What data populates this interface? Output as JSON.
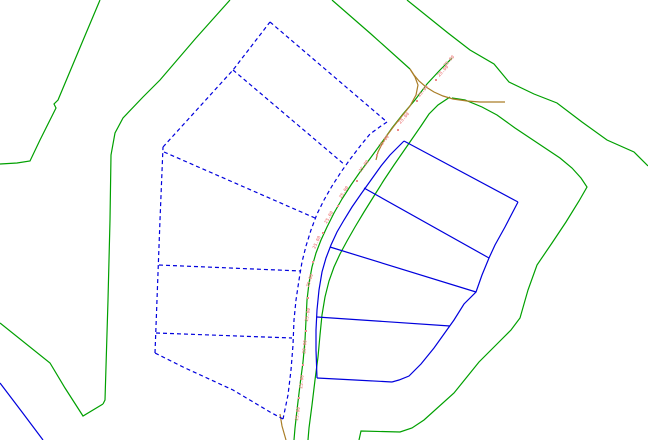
{
  "canvas": {
    "width": 648,
    "height": 440,
    "background": "#ffffff"
  },
  "palette": {
    "boundary_green": "#00a000",
    "parcel_blue": "#0000dd",
    "old_road_brown": "#aa7e28",
    "dimension_red": "#ef8a8a"
  },
  "layers": [
    {
      "name": "site-boundary-green",
      "color_key": "boundary_green",
      "dashed": false,
      "paths": [
        [
          [
            100,
            0
          ],
          [
            84,
            38
          ],
          [
            58,
            100
          ],
          [
            54,
            104
          ],
          [
            56,
            108
          ],
          [
            40,
            140
          ],
          [
            30,
            161
          ],
          [
            17,
            163
          ],
          [
            0,
            164
          ]
        ],
        [
          [
            0,
            323
          ],
          [
            50,
            363
          ],
          [
            65,
            388
          ],
          [
            83,
            416
          ],
          [
            103,
            404
          ]
        ],
        [
          [
            230,
            0
          ],
          [
            196,
            38
          ],
          [
            160,
            80
          ],
          [
            143,
            97
          ],
          [
            123,
            118
          ],
          [
            115,
            133
          ],
          [
            111,
            155
          ],
          [
            110,
            220
          ],
          [
            108,
            300
          ],
          [
            105,
            400
          ],
          [
            103,
            404
          ]
        ],
        [
          [
            332,
            0
          ],
          [
            371,
            34
          ],
          [
            410,
            69
          ]
        ],
        [
          [
            452,
            58
          ],
          [
            440,
            70
          ],
          [
            427,
            84
          ],
          [
            415,
            100
          ],
          [
            403,
            114
          ],
          [
            392,
            128
          ],
          [
            385,
            138
          ],
          [
            377,
            149
          ],
          [
            369,
            160
          ],
          [
            360,
            172
          ],
          [
            351,
            185
          ],
          [
            342,
            199
          ],
          [
            334,
            213
          ],
          [
            327,
            227
          ],
          [
            321,
            240
          ],
          [
            316,
            253
          ],
          [
            312,
            267
          ],
          [
            309,
            283
          ],
          [
            307,
            300
          ],
          [
            306,
            320
          ],
          [
            305,
            340
          ],
          [
            303,
            362
          ],
          [
            300,
            385
          ],
          [
            297,
            410
          ],
          [
            295,
            428
          ],
          [
            294,
            440
          ]
        ],
        [
          [
            450,
            97
          ],
          [
            438,
            105
          ],
          [
            429,
            114
          ],
          [
            421,
            126
          ],
          [
            412,
            139
          ],
          [
            403,
            152
          ],
          [
            394,
            165
          ],
          [
            384,
            180
          ],
          [
            374,
            196
          ],
          [
            364,
            212
          ],
          [
            355,
            227
          ],
          [
            347,
            241
          ],
          [
            340,
            254
          ],
          [
            334,
            267
          ],
          [
            329,
            281
          ],
          [
            325,
            297
          ],
          [
            322,
            315
          ],
          [
            320,
            335
          ],
          [
            318,
            357
          ],
          [
            315,
            380
          ],
          [
            312,
            405
          ],
          [
            309,
            428
          ],
          [
            308,
            440
          ]
        ],
        [
          [
            407,
            0
          ],
          [
            448,
            33
          ],
          [
            470,
            50
          ],
          [
            494,
            64
          ],
          [
            509,
            82
          ],
          [
            534,
            94
          ],
          [
            557,
            103
          ],
          [
            582,
            122
          ],
          [
            607,
            140
          ],
          [
            634,
            152
          ],
          [
            648,
            166
          ]
        ],
        [
          [
            452,
            98
          ],
          [
            465,
            100
          ],
          [
            482,
            107
          ],
          [
            497,
            115
          ],
          [
            515,
            128
          ],
          [
            530,
            138
          ],
          [
            545,
            148
          ],
          [
            560,
            158
          ],
          [
            572,
            168
          ],
          [
            581,
            178
          ],
          [
            587,
            187
          ],
          [
            579,
            201
          ],
          [
            566,
            222
          ],
          [
            552,
            243
          ],
          [
            537,
            265
          ],
          [
            528,
            290
          ],
          [
            520,
            318
          ],
          [
            511,
            330
          ],
          [
            501,
            340
          ],
          [
            479,
            362
          ],
          [
            454,
            393
          ],
          [
            424,
            420
          ],
          [
            412,
            428
          ],
          [
            400,
            432
          ],
          [
            361,
            431
          ],
          [
            359,
            440
          ]
        ]
      ]
    },
    {
      "name": "old-road-alignment-brown",
      "color_key": "old_road_brown",
      "dashed": false,
      "paths": [
        [
          [
            410,
            69
          ],
          [
            415,
            77
          ],
          [
            418,
            85
          ],
          [
            416,
            95
          ],
          [
            410,
            106
          ],
          [
            402,
            116
          ],
          [
            394,
            126
          ],
          [
            388,
            134
          ],
          [
            383,
            142
          ],
          [
            378,
            152
          ],
          [
            376,
            160
          ]
        ],
        [
          [
            410,
            69
          ],
          [
            414,
            75
          ],
          [
            419,
            81
          ],
          [
            426,
            87
          ],
          [
            434,
            92
          ],
          [
            443,
            96
          ],
          [
            453,
            99
          ],
          [
            467,
            101
          ],
          [
            480,
            102
          ],
          [
            505,
            102
          ]
        ],
        [
          [
            280,
            414
          ],
          [
            282,
            426
          ],
          [
            286,
            440
          ]
        ]
      ]
    },
    {
      "name": "proposed-parcels-dashed-blue",
      "color_key": "parcel_blue",
      "dashed": true,
      "paths": [
        [
          [
            270,
            22
          ],
          [
            387,
            122
          ]
        ],
        [
          [
            387,
            122
          ],
          [
            381,
            126
          ],
          [
            370,
            134
          ],
          [
            361,
            145
          ],
          [
            351,
            158
          ],
          [
            341,
            172
          ],
          [
            332,
            186
          ],
          [
            324,
            200
          ],
          [
            317,
            214
          ],
          [
            311,
            230
          ],
          [
            306,
            246
          ],
          [
            302,
            262
          ],
          [
            299,
            280
          ],
          [
            296,
            300
          ],
          [
            294,
            320
          ],
          [
            293,
            345
          ],
          [
            291,
            370
          ],
          [
            288,
            395
          ],
          [
            283,
            419
          ]
        ],
        [
          [
            283,
            419
          ],
          [
            270,
            412
          ],
          [
            233,
            390
          ],
          [
            183,
            367
          ],
          [
            155,
            353
          ]
        ],
        [
          [
            155,
            353
          ],
          [
            160,
            220
          ],
          [
            163,
            147
          ]
        ],
        [
          [
            163,
            147
          ],
          [
            233,
            70
          ],
          [
            270,
            22
          ]
        ],
        [
          [
            233,
            70
          ],
          [
            345,
            165
          ]
        ],
        [
          [
            164,
            152
          ],
          [
            315,
            218
          ]
        ],
        [
          [
            159,
            265
          ],
          [
            301,
            271
          ]
        ],
        [
          [
            156,
            333
          ],
          [
            292,
            338
          ]
        ]
      ]
    },
    {
      "name": "parcels-solid-blue",
      "color_key": "parcel_blue",
      "dashed": false,
      "paths": [
        [
          [
            404,
            141
          ],
          [
            398,
            147
          ],
          [
            390,
            155
          ],
          [
            381,
            166
          ],
          [
            371,
            180
          ],
          [
            361,
            194
          ],
          [
            352,
            207
          ],
          [
            344,
            220
          ],
          [
            337,
            232
          ],
          [
            331,
            245
          ],
          [
            326,
            258
          ],
          [
            322,
            272
          ],
          [
            319,
            290
          ],
          [
            317,
            310
          ],
          [
            316,
            330
          ],
          [
            316,
            350
          ],
          [
            317,
            378
          ]
        ],
        [
          [
            404,
            141
          ],
          [
            518,
            202
          ]
        ],
        [
          [
            518,
            202
          ],
          [
            505,
            227
          ],
          [
            495,
            245
          ],
          [
            489,
            258
          ],
          [
            482,
            275
          ],
          [
            476,
            292
          ],
          [
            464,
            304
          ],
          [
            454,
            320
          ],
          [
            444,
            334
          ],
          [
            434,
            348
          ],
          [
            421,
            364
          ],
          [
            409,
            376
          ],
          [
            399,
            380
          ],
          [
            392,
            382
          ]
        ],
        [
          [
            392,
            382
          ],
          [
            355,
            380
          ],
          [
            317,
            378
          ]
        ],
        [
          [
            364,
            188
          ],
          [
            489,
            258
          ]
        ],
        [
          [
            330,
            247
          ],
          [
            476,
            292
          ]
        ],
        [
          [
            317,
            317
          ],
          [
            450,
            326
          ]
        ],
        [
          [
            0,
            383
          ],
          [
            22,
            412
          ],
          [
            43,
            440
          ]
        ]
      ]
    }
  ],
  "dimension_labels": {
    "text": "25.00",
    "color_key": "dimension_red",
    "items": [
      {
        "x": 450,
        "y": 62,
        "angle": -47
      },
      {
        "x": 444,
        "y": 72,
        "angle": -47
      },
      {
        "x": 424,
        "y": 92,
        "angle": -50
      },
      {
        "x": 405,
        "y": 119,
        "angle": -49
      },
      {
        "x": 385,
        "y": 142,
        "angle": -52
      },
      {
        "x": 365,
        "y": 167,
        "angle": -54
      },
      {
        "x": 345,
        "y": 193,
        "angle": -57
      },
      {
        "x": 330,
        "y": 218,
        "angle": -60
      },
      {
        "x": 318,
        "y": 243,
        "angle": -65
      },
      {
        "x": 311,
        "y": 281,
        "angle": -72
      },
      {
        "x": 309,
        "y": 315,
        "angle": -80
      },
      {
        "x": 306,
        "y": 347,
        "angle": -85
      },
      {
        "x": 303,
        "y": 382,
        "angle": -84
      },
      {
        "x": 299,
        "y": 414,
        "angle": -82
      }
    ]
  },
  "station_ticks": {
    "color_key": "dimension_red",
    "size": 2,
    "points": [
      [
        436,
        80
      ],
      [
        417,
        101
      ],
      [
        398,
        130
      ],
      [
        377,
        155
      ],
      [
        357,
        181
      ],
      [
        338,
        206
      ],
      [
        323,
        233
      ],
      [
        313,
        262
      ],
      [
        308,
        298
      ],
      [
        306,
        331
      ],
      [
        303,
        365
      ],
      [
        299,
        398
      ]
    ]
  }
}
